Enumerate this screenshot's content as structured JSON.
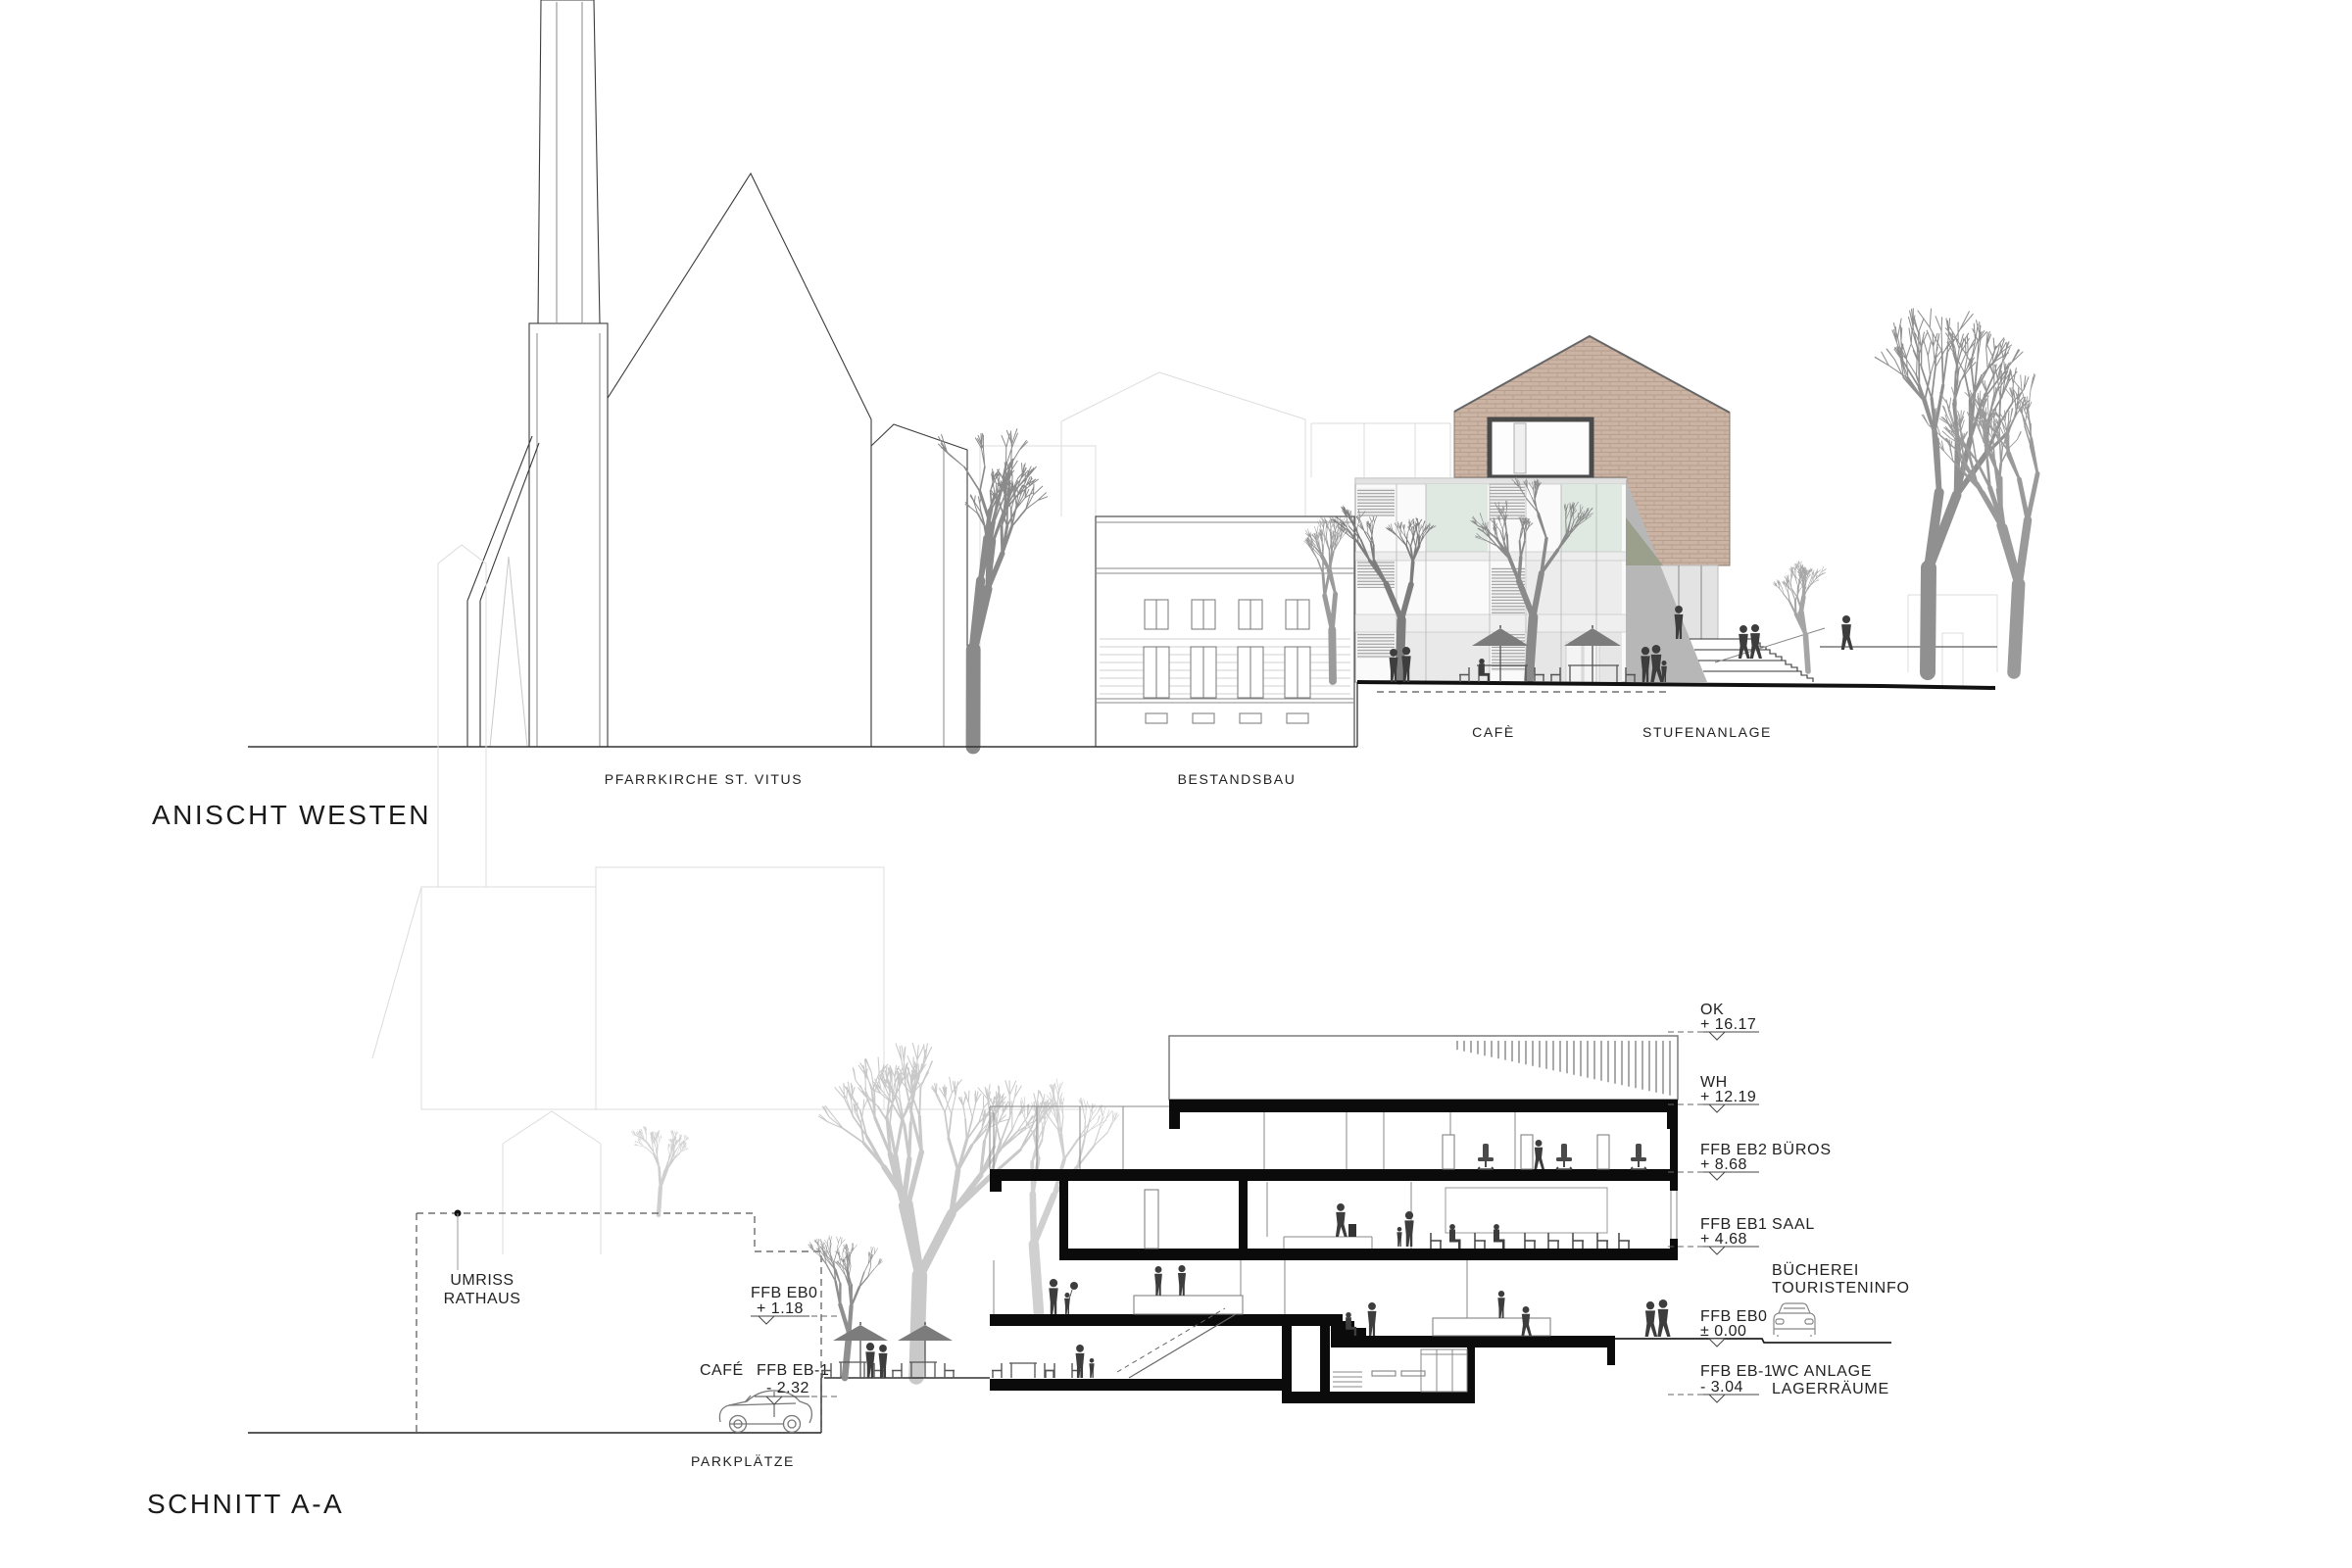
{
  "titles": {
    "elevation": "ANISCHT WESTEN",
    "section": "SCHNITT A-A"
  },
  "elevation_labels": {
    "church": "PFARRKIRCHE ST. VITUS",
    "existing_building": "BESTANDSBAU",
    "cafe": "CAFÈ",
    "steps": "STUFENANLAGE"
  },
  "section_labels": {
    "umriss_line1": "UMRISS",
    "umriss_line2": "RATHAUS",
    "parking": "PARKPLÄTZE",
    "cafe": "CAFÉ",
    "left_markers": {
      "eb0": {
        "name": "FFB EB0",
        "value": "+ 1.18"
      },
      "ebm1": {
        "name": "FFB EB-1",
        "value": "- 2.32"
      }
    },
    "right_markers": [
      {
        "name": "OK",
        "value": "+ 16.17",
        "room": "",
        "room2": ""
      },
      {
        "name": "WH",
        "value": "+ 12.19",
        "room": "",
        "room2": ""
      },
      {
        "name": "FFB EB2",
        "value": "+ 8.68",
        "room": "BÜROS",
        "room2": ""
      },
      {
        "name": "FFB EB1",
        "value": "+ 4.68",
        "room": "SAAL",
        "room2": ""
      },
      {
        "name": "",
        "value": "",
        "room": "BÜCHEREI",
        "room2": "TOURISTENINFO"
      },
      {
        "name": "FFB EB0",
        "value": "± 0.00",
        "room": "",
        "room2": ""
      },
      {
        "name": "FFB EB-1",
        "value": "- 3.04",
        "room": "WC ANLAGE",
        "room2": "LAGERRÄUME"
      }
    ]
  },
  "icons": {
    "car_side": "car-side-icon",
    "car_front": "car-front-icon",
    "level_marker": "level-marker-icon",
    "umbrella": "umbrella-icon",
    "reference_dot": "reference-dot-icon"
  },
  "colors": {
    "brick": "#cbb4a4",
    "brick_joint": "#b69d8d",
    "glass_green": "#dfe9e2",
    "wedge_gray": "#b7b7b7",
    "olive": "#9aa08c",
    "tree_dark": "#8a8a8a",
    "tree_light": "#c9c9c9",
    "people": "#3d3d3d",
    "cut_black": "#0b0b0b"
  }
}
